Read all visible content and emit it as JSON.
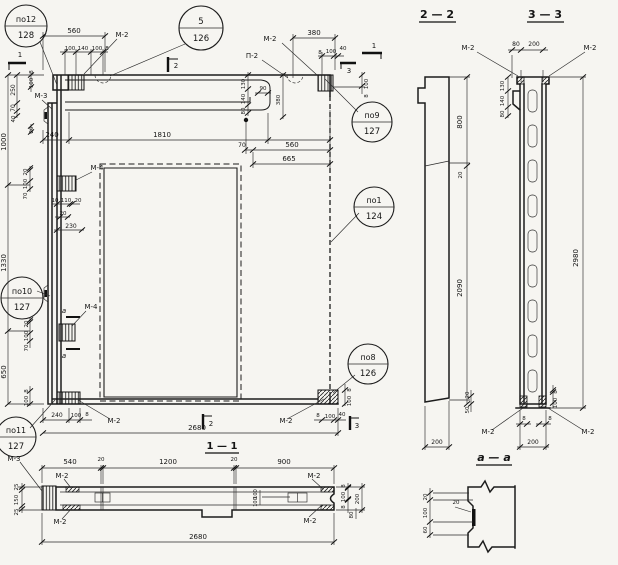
{
  "callouts": {
    "po12": {
      "pos": "по12",
      "sheet": "128"
    },
    "p5": {
      "pos": "5",
      "sheet": "126"
    },
    "po9": {
      "pos": "по9",
      "sheet": "127"
    },
    "po1": {
      "pos": "по1",
      "sheet": "124"
    },
    "po10": {
      "pos": "по10",
      "sheet": "127"
    },
    "po8": {
      "pos": "по8",
      "sheet": "126"
    },
    "po11": {
      "pos": "по11",
      "sheet": "127"
    }
  },
  "marks": {
    "m2": "М-2",
    "m3": "М-3",
    "m4": "М-4",
    "p2": "П-2",
    "a": "а"
  },
  "cut_labels": {
    "c1": "1",
    "c2": "2",
    "c3": "3"
  },
  "section_titles": {
    "s22": "2 — 2",
    "s33": "3 — 3",
    "s11": "1 — 1",
    "saa": "а — а"
  },
  "dims": {
    "main": {
      "top560": "560",
      "tl_chain": [
        "100",
        "140",
        "100",
        "8"
      ],
      "tr380": "380",
      "tr_chain": [
        "8",
        "100",
        "40"
      ],
      "w240": "240",
      "w1810": "1810",
      "w70": "70",
      "w560": "560",
      "w665": "665",
      "lt8": "8",
      "lt100": "100",
      "lt250": "250",
      "lt70": "70",
      "lt40": "40",
      "lt20": "20",
      "h1000": "1000",
      "h1330": "1330",
      "h650": "650",
      "m1_chain": [
        "20",
        "100",
        "70"
      ],
      "anchor_chain": [
        "10",
        "110",
        "20"
      ],
      "a20": "20",
      "a230": "230",
      "m2_chain": [
        "20",
        "100",
        "70"
      ],
      "bl8": "8",
      "bl100": "100",
      "bot_chain": [
        "240",
        "100",
        "8"
      ],
      "w2680": "2680",
      "br_chain": [
        "8",
        "100",
        "40"
      ],
      "rb8": "8",
      "rb100": "100",
      "rt100": "100",
      "rt8": "8",
      "rib_chain": [
        "130",
        "140",
        "80"
      ],
      "rib90": "90",
      "rib380": "380"
    },
    "s22": {
      "h800": "800",
      "h20": "20",
      "h2090": "2090",
      "w200": "200",
      "b20": "20",
      "b50": "50"
    },
    "s33": {
      "t80": "80",
      "t200": "200",
      "l_chain": [
        "130",
        "140",
        "80"
      ],
      "h2980": "2980",
      "f8l": "8",
      "f8r": "8",
      "w200": "200",
      "r8": "8",
      "r100": "100"
    },
    "s11": {
      "top_chain": [
        "540",
        "20",
        "1200",
        "20",
        "900"
      ],
      "left_chain": [
        "25",
        "150",
        "25"
      ],
      "right_chain": [
        "8",
        "100",
        "8"
      ],
      "r80": "80",
      "r200": "200",
      "holes": [
        "100",
        "100"
      ],
      "w2680": "2680"
    },
    "saa": {
      "v_chain": [
        "20",
        "100",
        "60"
      ],
      "h20": "20"
    }
  }
}
